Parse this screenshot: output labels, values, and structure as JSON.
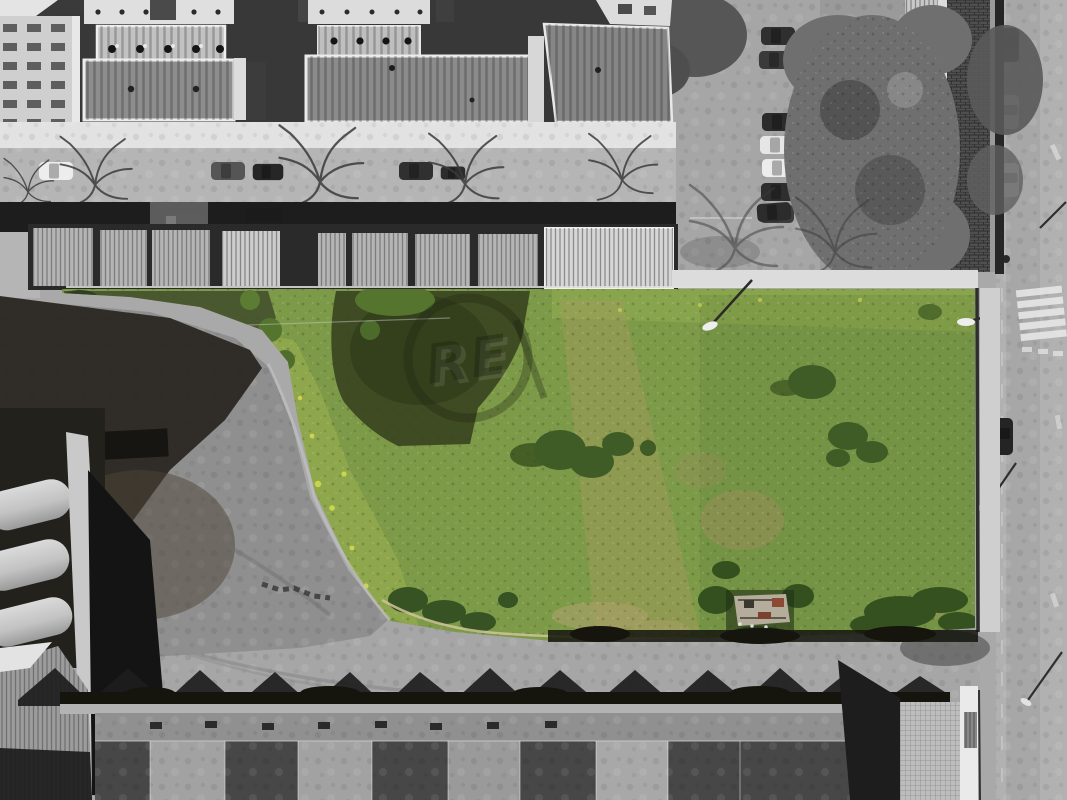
{
  "meta": {
    "description": "Aerial drone photograph of a vacant grass land plot shown in color, surrounded by desaturated grayscale apartment buildings, garages, streets, parked cars and industrial sawtooth-roof halls"
  },
  "watermark": {
    "text": "RE"
  },
  "palette": {
    "grass": "#7c9a48",
    "grass_light": "#9cb050",
    "grass_top": "#93ad4f",
    "grass_yellow": "#d4d84f",
    "bush": "#3f5c26",
    "bush_dark": "#2f4520",
    "shadow_olive": "#39441f",
    "dry": "#a89a5e",
    "trail": "#cfc49b",
    "street": "#b5b5b5",
    "sidewalk": "#e2e2e2",
    "right_road": "#b1b1b1",
    "bottom_ground": "#a6a6a6",
    "shadow": "#1d1d1d",
    "hedge": "#15150e",
    "apartment_roof": "#8d8d8d",
    "garage_roof": "#b5b5b5",
    "tiled_roof": "#4f4f4f",
    "gravel": "#8f8f8f",
    "yard_shadow": "#2c2822",
    "canopy": "#6f6f6f",
    "white_wall": "#eaeaea",
    "crosswalk": "#eaeaea",
    "industrial_dark": "#474747",
    "industrial_flat": "#909090",
    "silo": "#c6c6c6",
    "watermark_ink": "#1a2210"
  }
}
